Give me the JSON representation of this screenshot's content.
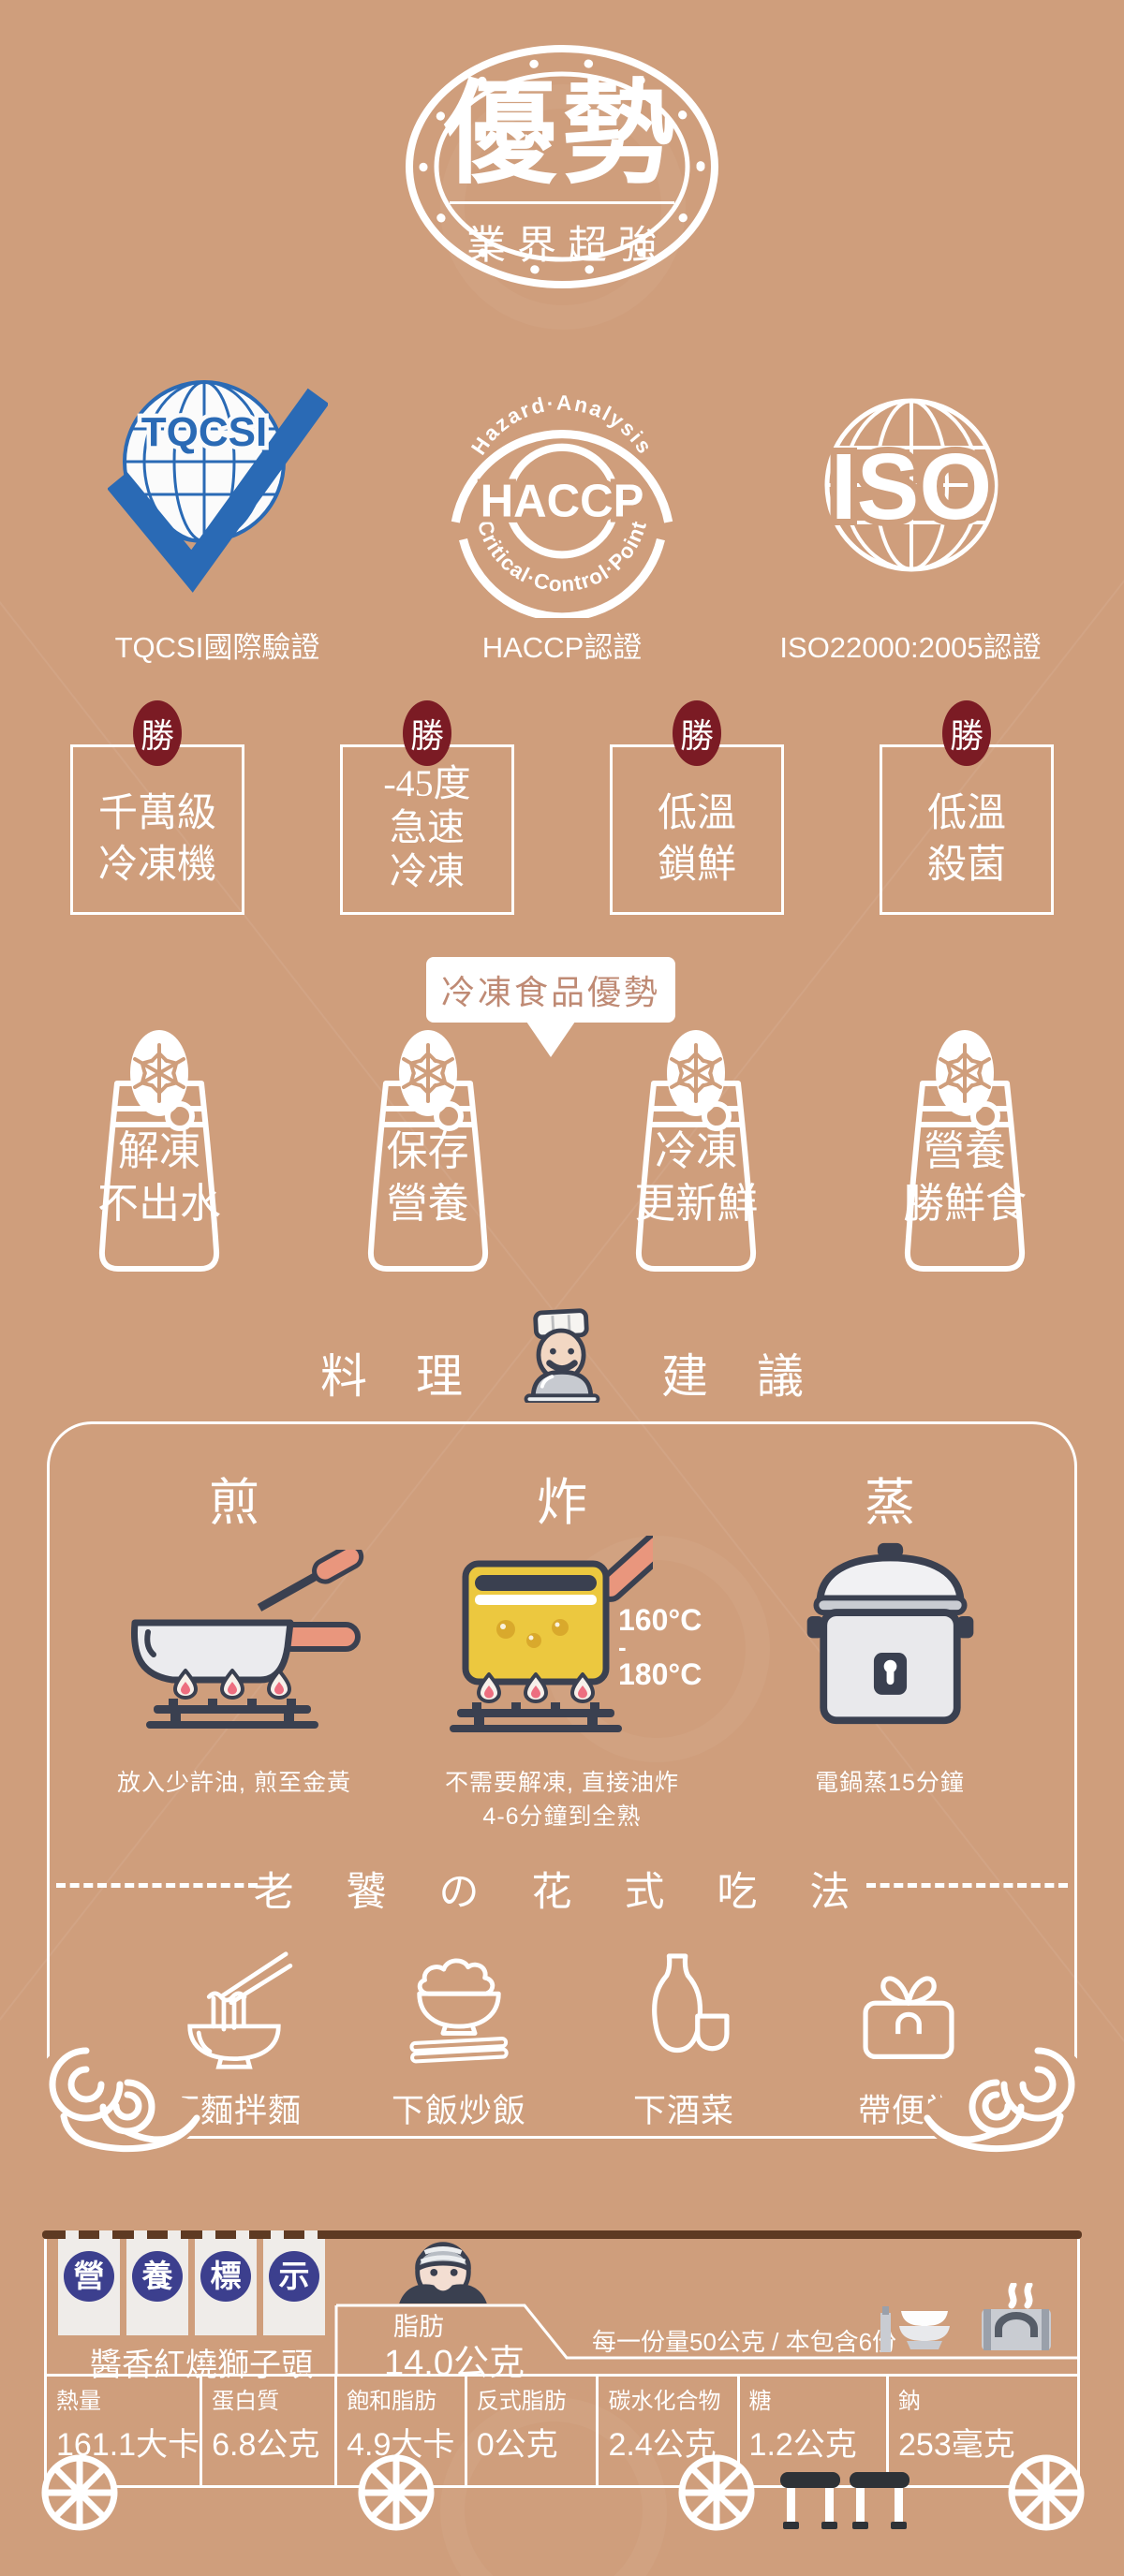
{
  "colors": {
    "background": "#cf9e7c",
    "white": "#ffffff",
    "maroon_badge": "#7b1b24",
    "navy_tag_circle": "#3c3f8e",
    "roof_brown": "#5e3a23",
    "icon_outline": "#3a4050",
    "salmon_handle": "#e9967d",
    "oil_yellow": "#ecc83f",
    "bubble_text": "#bf8a74",
    "tqcsi_blue": "#2a6ab5"
  },
  "stamp": {
    "title": "優勢",
    "subtitle": "業界超強"
  },
  "certifications": {
    "tqcsi": {
      "logo_text": "TQCSI",
      "label": "TQCSI國際驗證"
    },
    "haccp": {
      "arc_top": "Hazard·Analysis",
      "logo_text": "HACCP",
      "arc_bottom": "Critical·Control·Point",
      "label": "HACCP認證"
    },
    "iso": {
      "logo_text": "ISO",
      "label": "ISO22000:2005認證"
    }
  },
  "advantages": {
    "badge": "勝",
    "boxes": [
      {
        "line1": "千萬級",
        "line2": "冷凍機"
      },
      {
        "line1": "-45度",
        "line2": "急速",
        "line3": "冷凍"
      },
      {
        "line1": "低溫",
        "line2": "鎖鮮"
      },
      {
        "line1": "低溫",
        "line2": "殺菌"
      }
    ]
  },
  "frozen": {
    "bubble": "冷凍食品優勢",
    "bags": [
      {
        "line1": "解凍",
        "line2": "不出水"
      },
      {
        "line1": "保存",
        "line2": "營養"
      },
      {
        "line1": "冷凍",
        "line2": "更新鮮"
      },
      {
        "line1": "營養",
        "line2": "勝鮮食"
      }
    ]
  },
  "cooking": {
    "title_chars": [
      "料",
      "理",
      "建",
      "議"
    ],
    "methods": [
      {
        "title": "煎",
        "caption1": "放入少許油, 煎至金黃"
      },
      {
        "title": "炸",
        "caption1": "不需要解凍, 直接油炸",
        "caption2": "4-6分鐘到全熟",
        "temp_top": "160°C",
        "temp_mid": "-",
        "temp_bottom": "180°C"
      },
      {
        "title": "蒸",
        "caption1": "電鍋蒸15分鐘"
      }
    ],
    "divider": "老 饕 の 花 式 吃 法",
    "ways": [
      {
        "label": "下麵拌麵"
      },
      {
        "label": "下飯炒飯"
      },
      {
        "label": "下酒菜"
      },
      {
        "label": "帶便當"
      }
    ]
  },
  "nutrition": {
    "tags": [
      {
        "char": "營"
      },
      {
        "char": "養"
      },
      {
        "char": "標"
      },
      {
        "char": "示"
      }
    ],
    "product": "醬香紅燒獅子頭",
    "fat_label": "脂肪",
    "fat_value": "14.0公克",
    "serving": "每一份量50公克 / 本包含6份",
    "cells": [
      {
        "label": "熱量",
        "value": "161.1大卡"
      },
      {
        "label": "蛋白質",
        "value": "6.8公克"
      },
      {
        "label": "飽和脂肪",
        "value": "4.9大卡"
      },
      {
        "label": "反式脂肪",
        "value": "0公克"
      },
      {
        "label": "碳水化合物",
        "value": "2.4公克"
      },
      {
        "label": "糖",
        "value": "1.2公克"
      },
      {
        "label": "鈉",
        "value": "253毫克"
      }
    ]
  }
}
